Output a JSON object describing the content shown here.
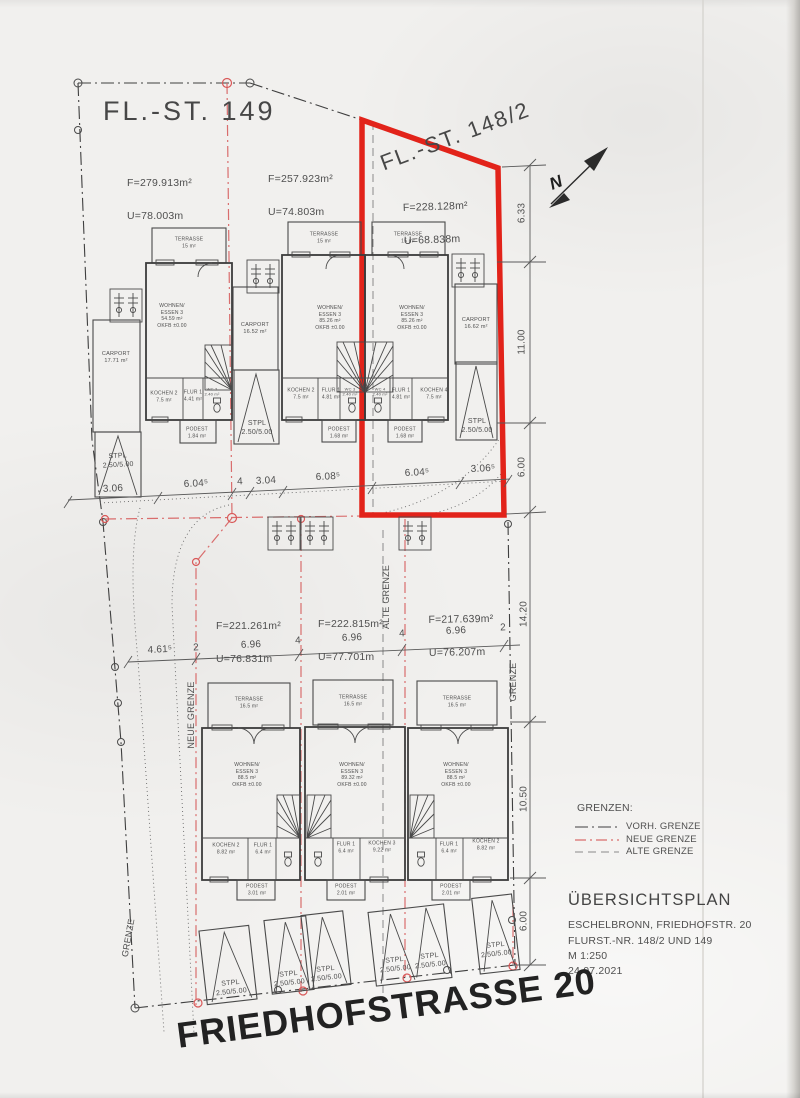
{
  "document": {
    "parcel149_label": "FL.-ST. 149",
    "parcel148_label": "FL.-ST. 148/2",
    "street_label": "FRIEDHOFSTRASSE 20",
    "north_label": "N"
  },
  "plots": {
    "p1": {
      "f": "F=279.913m²",
      "u": "U=78.003m"
    },
    "p2": {
      "f": "F=257.923m²",
      "u": "U=74.803m"
    },
    "p3": {
      "f": "F=228.128m²",
      "u": "U=68.838m"
    },
    "p4": {
      "f": "F=221.261m²",
      "u": "U=76.831m"
    },
    "p5": {
      "f": "F=222.815m²",
      "u": "U=77.701m"
    },
    "p6": {
      "f": "F=217.639m²",
      "u": "U=76.207m"
    }
  },
  "rooms": {
    "stpl": "STPL\n2.50/5.00",
    "t1": {
      "terrasse": "TERRASSE\n15 m²",
      "wohnen": "WOHNEN/\nESSEN 3\n54.59 m²\nOKFB ±0.00",
      "kochen": "KOCHEN 2\n7.5 m²",
      "flur": "FLUR 1\n4.41 m²",
      "wc": "WC 2\n2.40 m²",
      "podest": "PODEST\n1.84 m²",
      "carport": "CARPORT\n17.71 m²"
    },
    "t2": {
      "terrasse": "TERRASSE\n15 m²",
      "wohnen": "WOHNEN/\nESSEN 3\n85.26 m²\nOKFB ±0.00",
      "kochen": "KOCHEN 2\n7.5 m²",
      "flur": "FLUR 1\n4.81 m²",
      "wc": "WC 3\n2.40 m²",
      "podest": "PODEST\n1.68 m²",
      "carport": "CARPORT\n16.52 m²"
    },
    "t3": {
      "terrasse": "TERRASSE\n15 m²",
      "wohnen": "WOHNEN/\nESSEN 3\n85.26 m²\nOKFB ±0.00",
      "kochen": "KOCHEN 4\n7.5 m²",
      "flur": "FLUR 1\n4.81 m²",
      "wc": "WC 4\n2.40 m²",
      "podest": "PODEST\n1.68 m²",
      "carport": "CARPORT\n16.62 m²"
    },
    "b1": {
      "terrasse": "TERRASSE\n16.5 m²",
      "wohnen": "WOHNEN/\nESSEN 3\n88.5 m²\nOKFB ±0.00",
      "kochen": "KOCHEN 2\n8.82 m²",
      "flur": "FLUR 1\n6.4 m²",
      "podest": "PODEST\n3.01 m²"
    },
    "b2": {
      "terrasse": "TERRASSE\n16.5 m²",
      "wohnen": "WOHNEN/\nESSEN 3\n89.32 m²\nOKFB ±0.00",
      "kochen": "KOCHEN 3\n9.22 m²",
      "flur": "FLUR 1\n6.4 m²",
      "podest": "PODEST\n2.01 m²"
    },
    "b3": {
      "terrasse": "TERRASSE\n16.5 m²",
      "wohnen": "WOHNEN/\nESSEN 3\n88.5 m²\nOKFB ±0.00",
      "kochen": "KOCHEN 2\n8.82 m²",
      "flur": "FLUR 1\n6.4 m²",
      "podest": "PODEST\n2.01 m²"
    }
  },
  "dims": {
    "right_chain": [
      "6.33",
      "11.00",
      "6.00",
      "14.20",
      "10.50",
      "6.00"
    ],
    "mid_chain": [
      "3.06",
      "6.04⁵",
      "4",
      "3.04",
      "6.08⁵",
      "6.04⁵",
      "3.06⁵"
    ],
    "bottom_chain": [
      "4.61⁵",
      "2",
      "6.96",
      "4",
      "6.96",
      "4",
      "6.96",
      "2"
    ]
  },
  "grenzen": {
    "neue": "NEUE GRENZE",
    "alte": "ALTE GRENZE",
    "right": "GRENZE",
    "left": "GRENZE"
  },
  "legend": {
    "title": "GRENZEN:",
    "items": [
      "VORH. GRENZE",
      "NEUE GRENZE",
      "ALTE GRENZE"
    ]
  },
  "titleblock": {
    "title": "ÜBERSICHTSPLAN",
    "address": "ESCHELBRONN, FRIEDHOFSTR. 20",
    "parcels": "FLURST.-NR. 148/2 UND 149",
    "scale": "M 1:250",
    "date": "24.07.2021"
  },
  "colors": {
    "boundary_red": "#e2231a",
    "neue_grenze_red": "#d96d6d",
    "line_gray": "#4a4a4a"
  }
}
